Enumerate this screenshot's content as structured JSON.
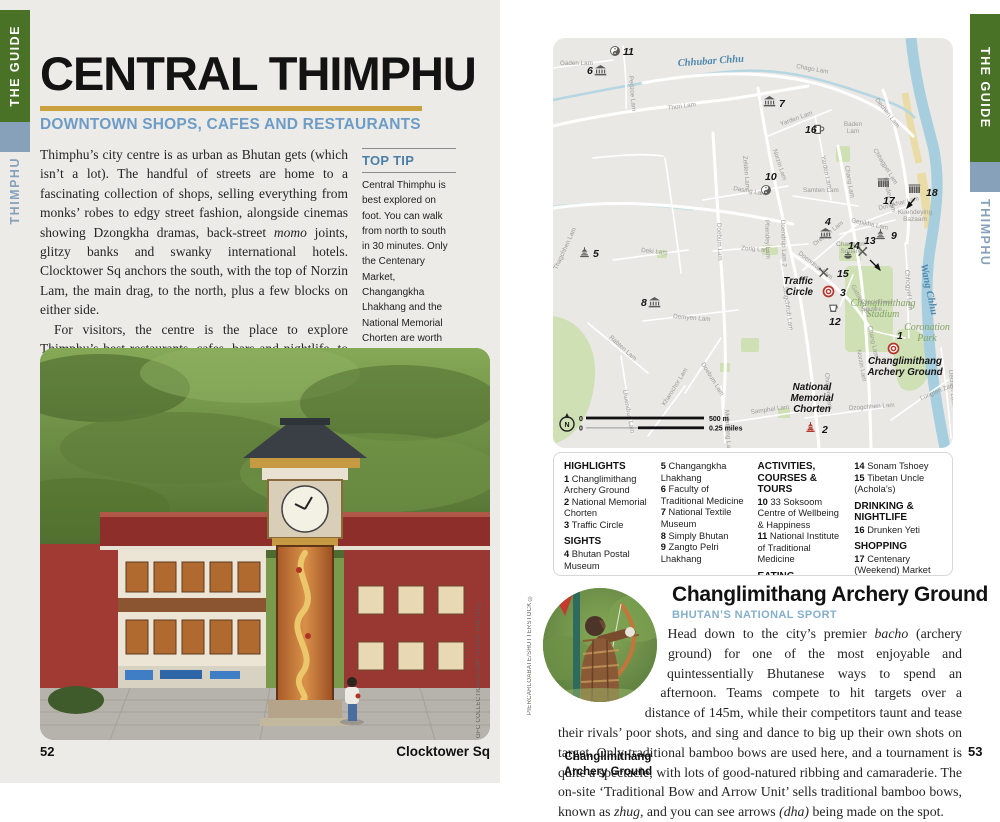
{
  "page_left": {
    "tab_guide": "THE GUIDE",
    "tab_region": "THIMPHU",
    "title": "CENTRAL THIMPHU",
    "subtitle": "DOWNTOWN SHOPS, CAFES AND RESTAURANTS",
    "intro_p1_segments": [
      {
        "t": "Thimphu’s city centre is as urban as Bhutan gets (which isn’t a lot). The handful of streets are home to a fascinating collection of shops, selling everything from monks’ robes to edgy street fashion, alongside cinemas showing Dzongkha dramas, back-street "
      },
      {
        "t": "momo",
        "i": true
      },
      {
        "t": " joints, glitzy banks and swanky international hotels. Clocktower Sq anchors the south, with the top of Norzin Lam, the main drag, to the north, plus a few blocks on either side."
      }
    ],
    "intro_p2": "For visitors, the centre is the place to explore Thimphu’s best restaurants, cafes, bars and nightlife, to get a taste of Bhutan’s traditional medicine and its modern art scene, or learn more about the nation’s twin obsessions – archery and weaving. There are also some fine sights, from the ionic National Memorial Chorten to the medieval Changangkha Lhakhang, and the shopping here is the best in the country.",
    "top_tip": {
      "heading": "TOP TIP",
      "body": "Central Thimphu is best explored on foot. You can walk from north to south in 30 minutes. Only the Centenary Market, Changangkha Lhakhang and the National Memorial Chorten are worth driving to. That said, you’ll likely combine the sights of central and greater Thimphu into a day’s sightseeing."
    },
    "photo_credit": "GFC COLLECTION/ALAMY STOCK PHOTO ©",
    "page_number": "52",
    "footer_caption": "Clocktower Sq"
  },
  "page_right": {
    "tab_guide": "THE GUIDE",
    "tab_region": "THIMPHU",
    "page_number": "53",
    "article": {
      "title": "Changlimithang Archery Ground",
      "kicker": "BHUTAN’S NATIONAL SPORT",
      "body_segments": [
        {
          "t": "Head down to the city’s premier "
        },
        {
          "t": "bacho",
          "i": true
        },
        {
          "t": " (archery ground) for one of the most enjoyable and quintessentially Bhutanese ways to spend an afternoon. Teams compete to hit targets over a distance of 145m, while their competitors taunt and tease their rivals’ poor shots, and sing and dance to big up their own shots on target. Only traditional bamboo bows are used here, and a tournament is quite a spectacle, with lots of good-natured ribbing and camaraderie. The on-site ‘Traditional Bow and Arrow Unit’ sells traditional bamboo bows, known as "
        },
        {
          "t": "zhug",
          "i": true
        },
        {
          "t": ", and you can see arrows "
        },
        {
          "t": "(dha)",
          "i": true
        },
        {
          "t": " being made on the spot."
        }
      ]
    },
    "photo_caption": "Changlimithang\nArchery Ground",
    "photo_credit": "PIERCARLOABATE/SHUTTERSTOCK ©"
  },
  "map": {
    "scale": {
      "north": "N",
      "zero": "0",
      "m": "500 m",
      "zero2": "0",
      "miles": "0.25 miles"
    },
    "colors": {
      "park": "#cfe0b5",
      "river": "#a6cede",
      "sand": "#e9dca6",
      "road": "#ffffff",
      "marker_red": "#b5352c",
      "marker_grey": "#5a5a58"
    },
    "street_labels": [
      {
        "t": "Gaden Lam",
        "x": 7,
        "y": 27,
        "r": 0
      },
      {
        "t": "Pedzoe Lam",
        "x": 76,
        "y": 38,
        "r": 85
      },
      {
        "t": "Chago Lam",
        "x": 243,
        "y": 30,
        "r": 10
      },
      {
        "t": "Thori Lam",
        "x": 115,
        "y": 72,
        "r": -8
      },
      {
        "t": "Thagchhen Lam",
        "x": 4,
        "y": 232,
        "r": -65
      },
      {
        "t": "Yarden Lam",
        "x": 228,
        "y": 88,
        "r": -20
      },
      {
        "t": "Yarden Lam",
        "x": 268,
        "y": 118,
        "r": 78
      },
      {
        "t": "Baden|Lam",
        "x": 300,
        "y": 88,
        "r": 0,
        "a": "m"
      },
      {
        "t": "Dechen Lam",
        "x": 322,
        "y": 62,
        "r": 52
      },
      {
        "t": "Chhagpel Lam",
        "x": 320,
        "y": 112,
        "r": 58
      },
      {
        "t": "Kundey Lam",
        "x": 330,
        "y": 140,
        "r": 75
      },
      {
        "t": "Chang Lam",
        "x": 292,
        "y": 128,
        "r": 80
      },
      {
        "t": "Dasing Lam",
        "x": 180,
        "y": 152,
        "r": 10
      },
      {
        "t": "Zelden Lam",
        "x": 190,
        "y": 118,
        "r": 85
      },
      {
        "t": "Norzin Lam",
        "x": 220,
        "y": 112,
        "r": 72
      },
      {
        "t": "Samten Lam",
        "x": 250,
        "y": 154,
        "r": 0
      },
      {
        "t": "Doebum Lam",
        "x": 164,
        "y": 185,
        "r": 88
      },
      {
        "t": "Phendey Lam",
        "x": 212,
        "y": 182,
        "r": 88
      },
      {
        "t": "Doendrup Lam 2",
        "x": 228,
        "y": 182,
        "r": 88
      },
      {
        "t": "Zorig Lam",
        "x": 188,
        "y": 212,
        "r": 4
      },
      {
        "t": "Doendrup Lam",
        "x": 245,
        "y": 216,
        "r": 38
      },
      {
        "t": "Jangchhub Lam",
        "x": 230,
        "y": 248,
        "r": 82
      },
      {
        "t": "Drenton Lam",
        "x": 262,
        "y": 208,
        "r": -38
      },
      {
        "t": "Gepikha Lam",
        "x": 298,
        "y": 184,
        "r": 12
      },
      {
        "t": "Dungkhar Lam",
        "x": 326,
        "y": 172,
        "r": -14
      },
      {
        "t": "Gatoen Lam",
        "x": 298,
        "y": 248,
        "r": 62
      },
      {
        "t": "Deki Lam",
        "x": 88,
        "y": 214,
        "r": 6
      },
      {
        "t": "Demyen Lam",
        "x": 120,
        "y": 280,
        "r": 5
      },
      {
        "t": "Rabten Lam",
        "x": 56,
        "y": 300,
        "r": 42
      },
      {
        "t": "Lhuendrup Lam",
        "x": 70,
        "y": 352,
        "r": 80
      },
      {
        "t": "Kharochor Lam",
        "x": 112,
        "y": 368,
        "r": -58
      },
      {
        "t": "Doebum Lam",
        "x": 148,
        "y": 326,
        "r": 58
      },
      {
        "t": "Chorten Lam",
        "x": 272,
        "y": 335,
        "r": 85
      },
      {
        "t": "Norzin Lam",
        "x": 304,
        "y": 312,
        "r": 80
      },
      {
        "t": "Chang Lam",
        "x": 315,
        "y": 288,
        "r": 78
      },
      {
        "t": "Melatheng Lam",
        "x": 172,
        "y": 372,
        "r": 87
      },
      {
        "t": "Samphel Lam",
        "x": 198,
        "y": 376,
        "r": -8
      },
      {
        "t": "Dzogchhen Lam",
        "x": 296,
        "y": 372,
        "r": -4
      },
      {
        "t": "Lungten Zampa",
        "x": 368,
        "y": 362,
        "r": -22
      },
      {
        "t": "Dechen Lam",
        "x": 396,
        "y": 332,
        "r": 85
      },
      {
        "t": "Chhogyel Lam",
        "x": 352,
        "y": 232,
        "r": 85
      }
    ],
    "place_labels": [
      {
        "t": "Chhubar Chhu",
        "x": 158,
        "y": 26,
        "s": "river",
        "r": -4,
        "a": "m"
      },
      {
        "t": "Wang Chhu",
        "x": 373,
        "y": 252,
        "s": "river",
        "r": 78,
        "a": "m"
      },
      {
        "t": "Changlimithang|Stadium",
        "x": 330,
        "y": 268,
        "s": "park",
        "a": "m"
      },
      {
        "t": "Coronation|Park",
        "x": 374,
        "y": 292,
        "s": "park",
        "a": "m"
      },
      {
        "t": "Traffic|Circle",
        "x": 260,
        "y": 246,
        "s": "poi",
        "a": "e"
      },
      {
        "t": "Changlimithang|Archery Ground",
        "x": 352,
        "y": 326,
        "s": "poi",
        "a": "m"
      },
      {
        "t": "National|Memorial|Chorten",
        "x": 259,
        "y": 352,
        "s": "poi",
        "a": "m"
      },
      {
        "t": "Kuendeying|Bazaam",
        "x": 362,
        "y": 176,
        "s": "sq",
        "a": "m"
      },
      {
        "t": "Changlom|Square",
        "x": 298,
        "y": 208,
        "s": "sq",
        "a": "m"
      },
      {
        "t": "Clocktower|Square",
        "x": 308,
        "y": 266,
        "s": "sq",
        "a": "s"
      }
    ],
    "markers": [
      {
        "n": "11",
        "x": 70,
        "y": 17,
        "icon": "yinyang",
        "ix": 57,
        "iy": 8
      },
      {
        "n": "6",
        "x": 34,
        "y": 36,
        "icon": "museum",
        "ix": 42,
        "iy": 27
      },
      {
        "n": "7",
        "x": 226,
        "y": 69,
        "icon": "museum",
        "ix": 211,
        "iy": 58
      },
      {
        "n": "16",
        "x": 252,
        "y": 95,
        "icon": "mug",
        "ix": 261,
        "iy": 86
      },
      {
        "n": "10",
        "x": 212,
        "y": 142,
        "icon": "yinyang",
        "ix": 208,
        "iy": 147
      },
      {
        "n": "17",
        "x": 330,
        "y": 166,
        "icon": "market",
        "ix": 325,
        "iy": 140
      },
      {
        "n": "18",
        "x": 373,
        "y": 158,
        "icon": "market",
        "ix": 356,
        "iy": 146
      },
      {
        "n": "4",
        "x": 272,
        "y": 187,
        "icon": "museum",
        "ix": 267,
        "iy": 190
      },
      {
        "n": "9",
        "x": 338,
        "y": 201,
        "icon": "temple",
        "ix": 322,
        "iy": 191
      },
      {
        "n": "13",
        "x": 311,
        "y": 206,
        "icon": "utensils",
        "ix": 305,
        "iy": 209
      },
      {
        "n": "14",
        "x": 295,
        "y": 211,
        "icon": "pot",
        "ix": 290,
        "iy": 214
      },
      {
        "n": "15",
        "x": 284,
        "y": 239,
        "icon": "utensils",
        "ix": 266,
        "iy": 230
      },
      {
        "n": "3",
        "x": 287,
        "y": 258,
        "icon": "ring",
        "ix": 270,
        "iy": 248,
        "red": true
      },
      {
        "n": "12",
        "x": 276,
        "y": 287,
        "icon": "cup",
        "ix": 276,
        "iy": 266
      },
      {
        "n": "1",
        "x": 344,
        "y": 301,
        "icon": "ring",
        "ix": 335,
        "iy": 305,
        "red": true
      },
      {
        "n": "2",
        "x": 269,
        "y": 395,
        "icon": "chorten",
        "ix": 252,
        "iy": 384,
        "red": true
      },
      {
        "n": "5",
        "x": 40,
        "y": 219,
        "icon": "temple",
        "ix": 26,
        "iy": 209
      },
      {
        "n": "8",
        "x": 88,
        "y": 268,
        "icon": "museum",
        "ix": 96,
        "iy": 259
      }
    ]
  },
  "legend": {
    "columns": [
      [
        {
          "h": "HIGHLIGHTS"
        },
        {
          "n": "1",
          "t": "Changlimithang Archery Ground"
        },
        {
          "n": "2",
          "t": "National Memorial Chorten"
        },
        {
          "n": "3",
          "t": "Traffic Circle"
        },
        {
          "h": "SIGHTS"
        },
        {
          "n": "4",
          "t": "Bhutan Postal Museum"
        }
      ],
      [
        {
          "n": "5",
          "t": "Changangkha Lhakhang"
        },
        {
          "n": "6",
          "t": "Faculty of Traditional Medicine"
        },
        {
          "n": "7",
          "t": "National Textile Museum"
        },
        {
          "n": "8",
          "t": "Simply Bhutan"
        },
        {
          "n": "9",
          "t": "Zangto Pelri Lhakhang"
        }
      ],
      [
        {
          "h": "ACTIVITIES, COURSES & TOURS"
        },
        {
          "n": "10",
          "t": "33 Soksoom Centre of Wellbeing & Happiness"
        },
        {
          "n": "11",
          "t": "National Institute of Traditional Medicine"
        },
        {
          "h": "EATING"
        },
        {
          "n": "12",
          "t": "Ambient Cafe"
        },
        {
          "n": "13",
          "t": "Chuniding Foods"
        }
      ],
      [
        {
          "n": "14",
          "t": "Sonam Tshoey"
        },
        {
          "n": "15",
          "t": "Tibetan Uncle (Achola’s)"
        },
        {
          "h": "DRINKING & NIGHTLIFE"
        },
        {
          "n": "16",
          "t": "Drunken Yeti"
        },
        {
          "h": "SHOPPING"
        },
        {
          "n": "17",
          "t": "Centenary (Weekend) Market"
        },
        {
          "n": "18",
          "t": "Handicrafts Market"
        }
      ]
    ]
  }
}
